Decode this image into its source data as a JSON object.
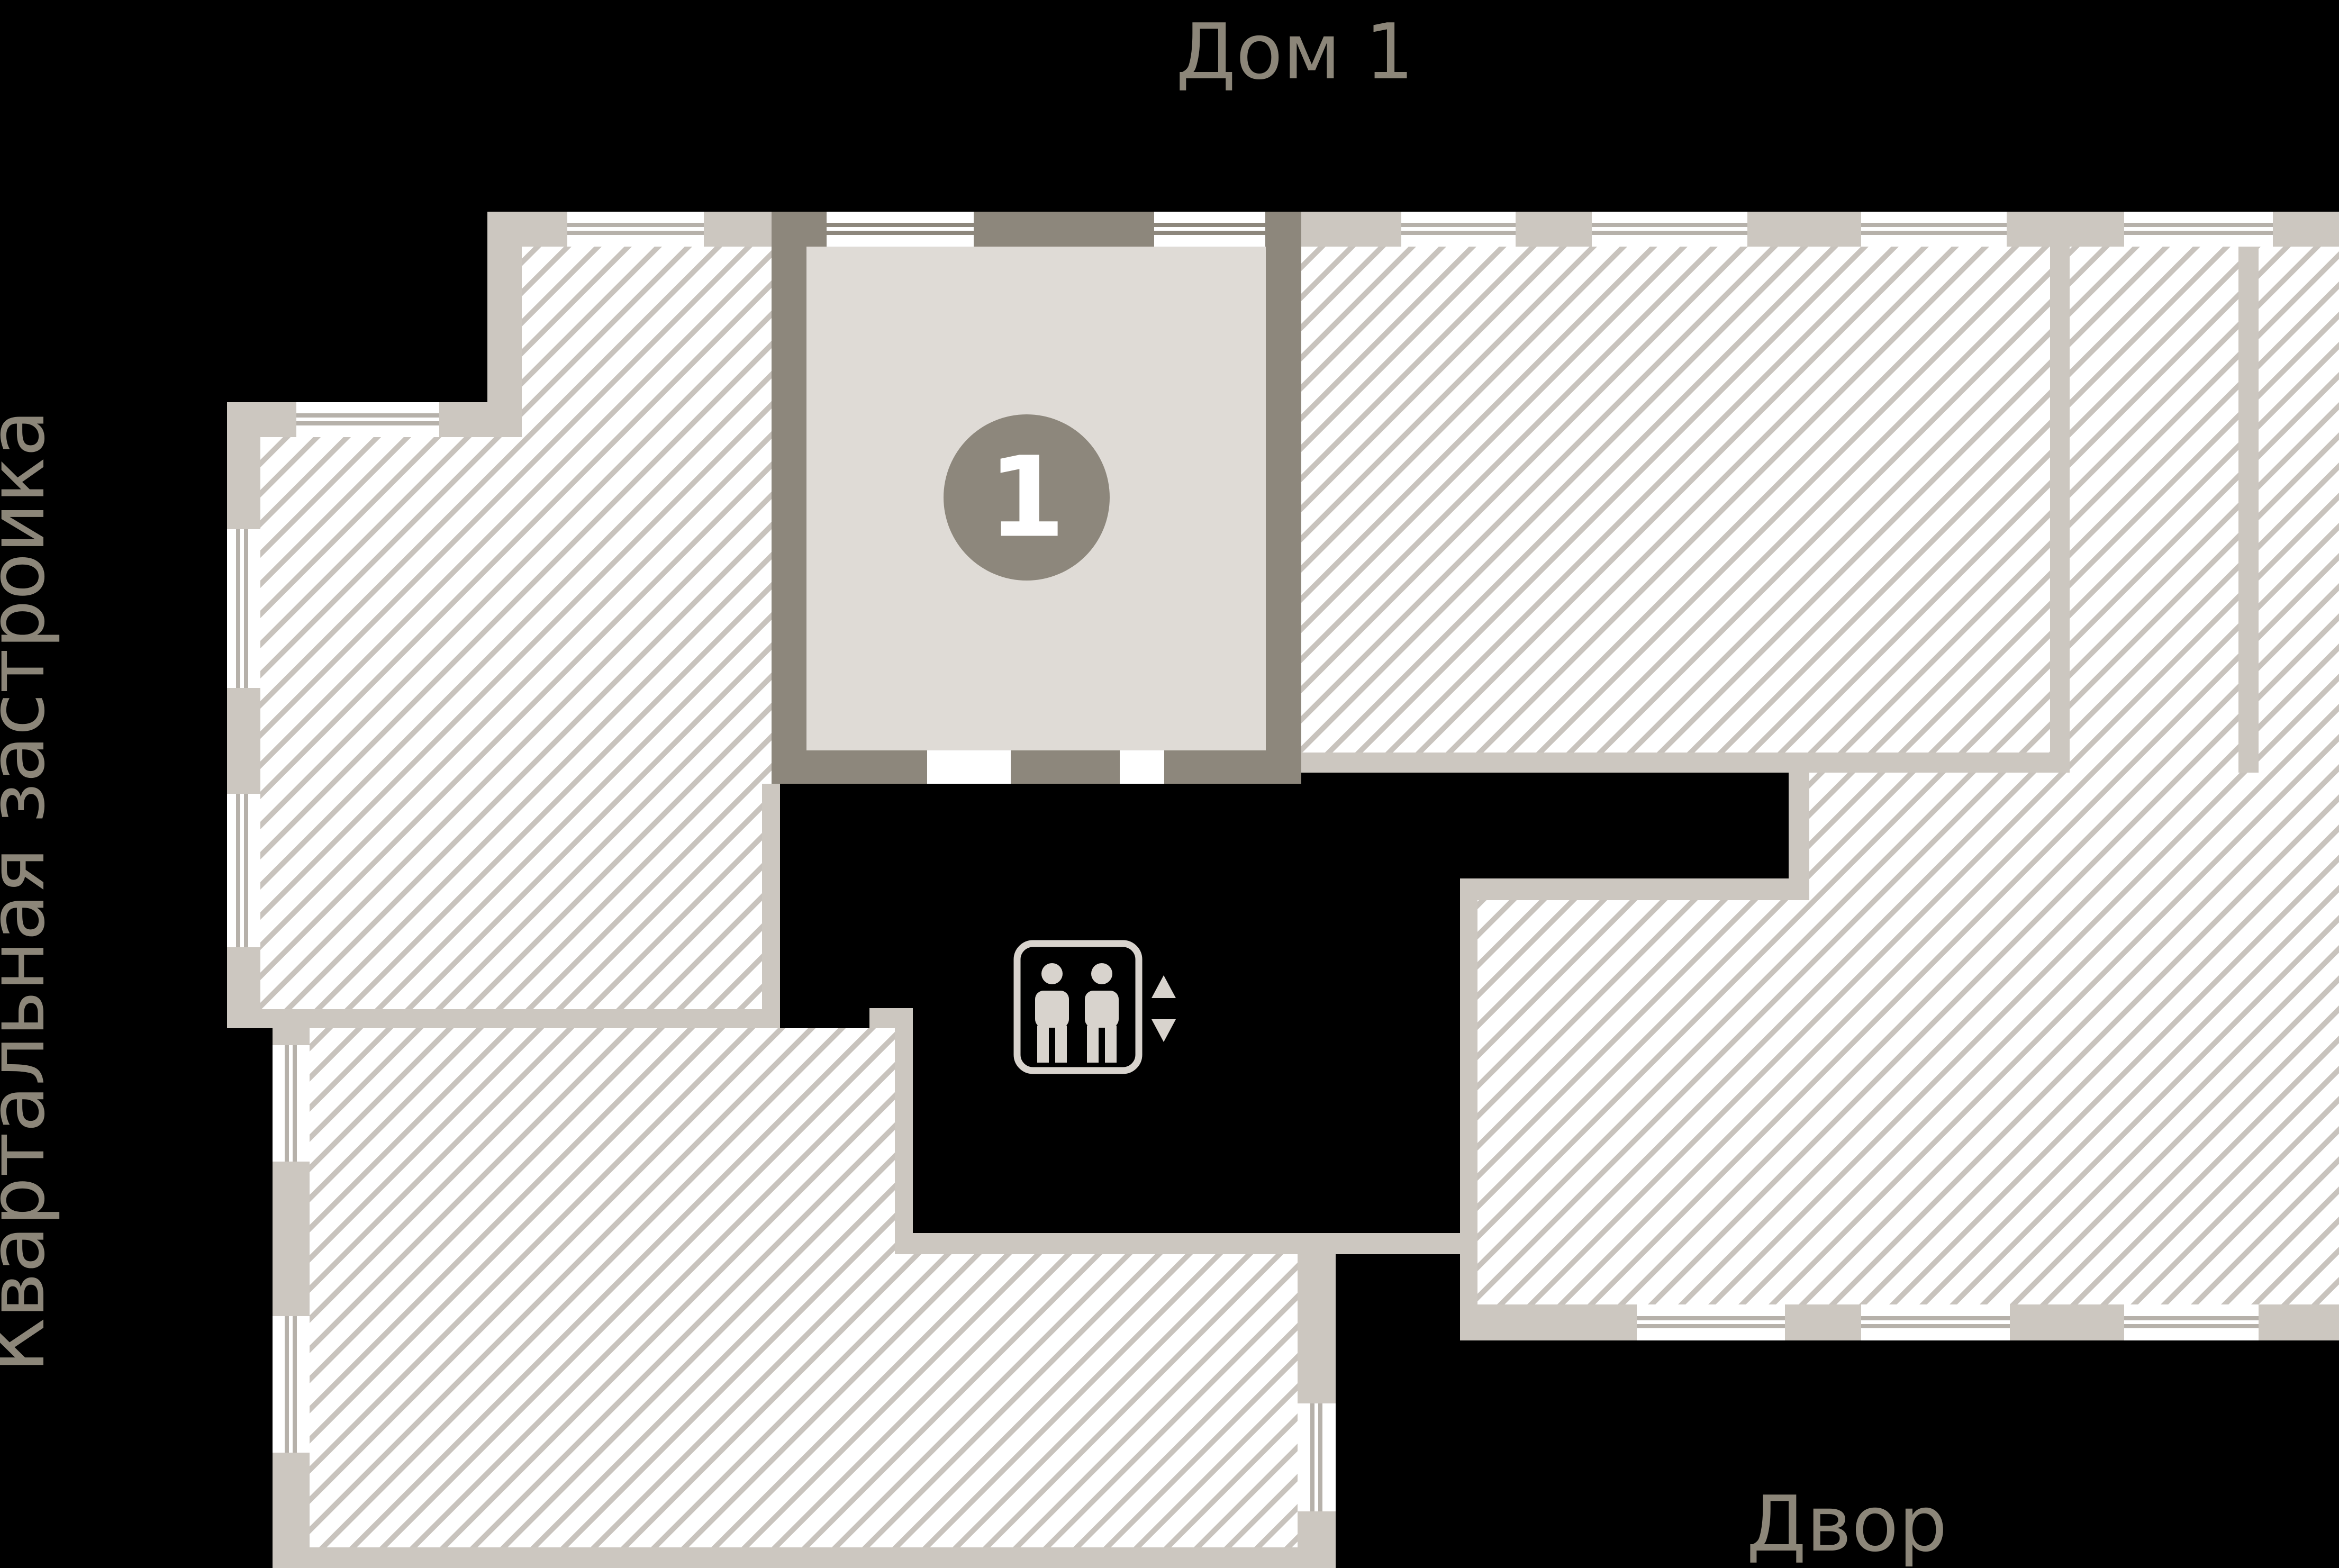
{
  "title": "Дом 1",
  "labels": {
    "left": "Квартальная застройка",
    "bottom": "Двор"
  },
  "selected_unit": {
    "number": "1",
    "status": "selected"
  },
  "icons": {
    "elevator": "elevator-icon",
    "elevator_up_arrow": "arrow-up-icon",
    "elevator_down_arrow": "arrow-down-icon"
  },
  "colors": {
    "background": "#000000",
    "wall_light": "#ccc7c0",
    "wall_dark": "#8d877c",
    "unit_fill": "#dfdbd6",
    "hatch_line": "#c8c3bd",
    "window_line": "#b6b1aa",
    "badge": "#8d877c",
    "text": "#8c8679",
    "icon": "#d8d3cd"
  }
}
